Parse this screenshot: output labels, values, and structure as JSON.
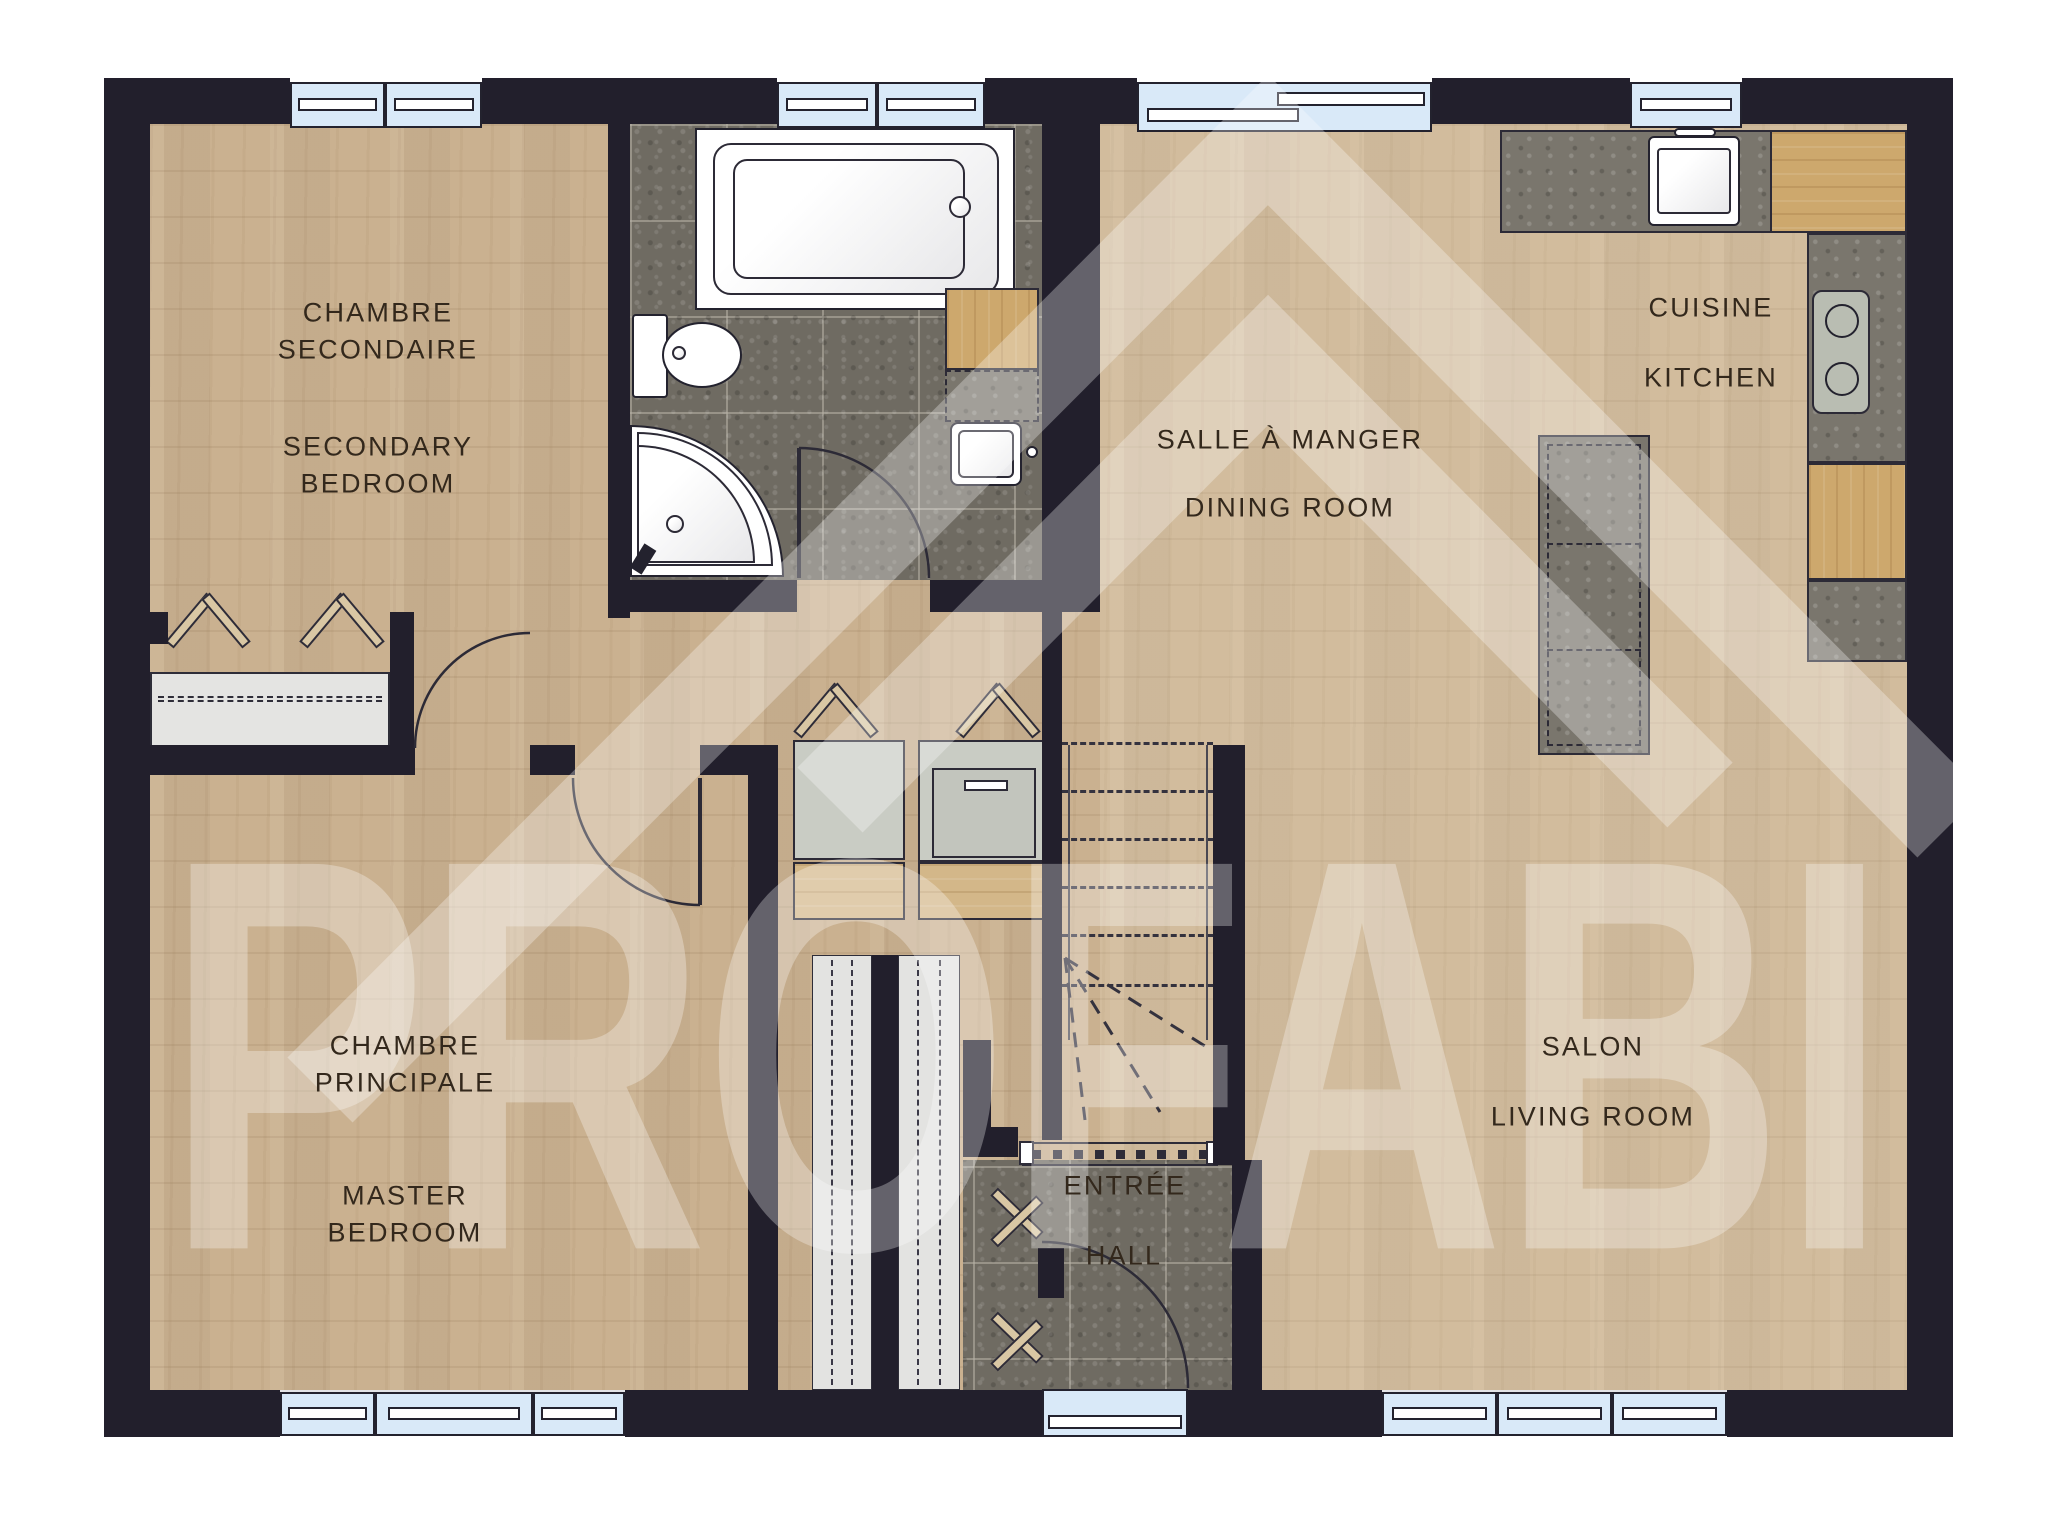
{
  "plan": {
    "watermark_text": "PROFABI",
    "colors": {
      "wall": "#221f2c",
      "wood_floor": "#cab190",
      "bath_tile": "#6f6b62",
      "window_glass": "#d9e9f8",
      "counter_stone": "#7a766d",
      "cabinet_wood": "#cda86d",
      "appliance_gray": "#c9ccc4",
      "label_text": "#33281c",
      "watermark_white": "rgba(255,255,255,0.30)"
    },
    "rooms": {
      "secondary_bedroom": {
        "fr1": "CHAMBRE",
        "fr2": "SECONDAIRE",
        "en1": "SECONDARY",
        "en2": "BEDROOM"
      },
      "master_bedroom": {
        "fr1": "CHAMBRE",
        "fr2": "PRINCIPALE",
        "en1": "MASTER",
        "en2": "BEDROOM"
      },
      "dining_room": {
        "fr": "SALLE À MANGER",
        "en": "DINING ROOM"
      },
      "kitchen": {
        "fr": "CUISINE",
        "en": "KITCHEN"
      },
      "living_room": {
        "fr": "SALON",
        "en": "LIVING ROOM"
      },
      "hall": {
        "fr": "ENTRÉE",
        "en": "HALL"
      }
    }
  }
}
